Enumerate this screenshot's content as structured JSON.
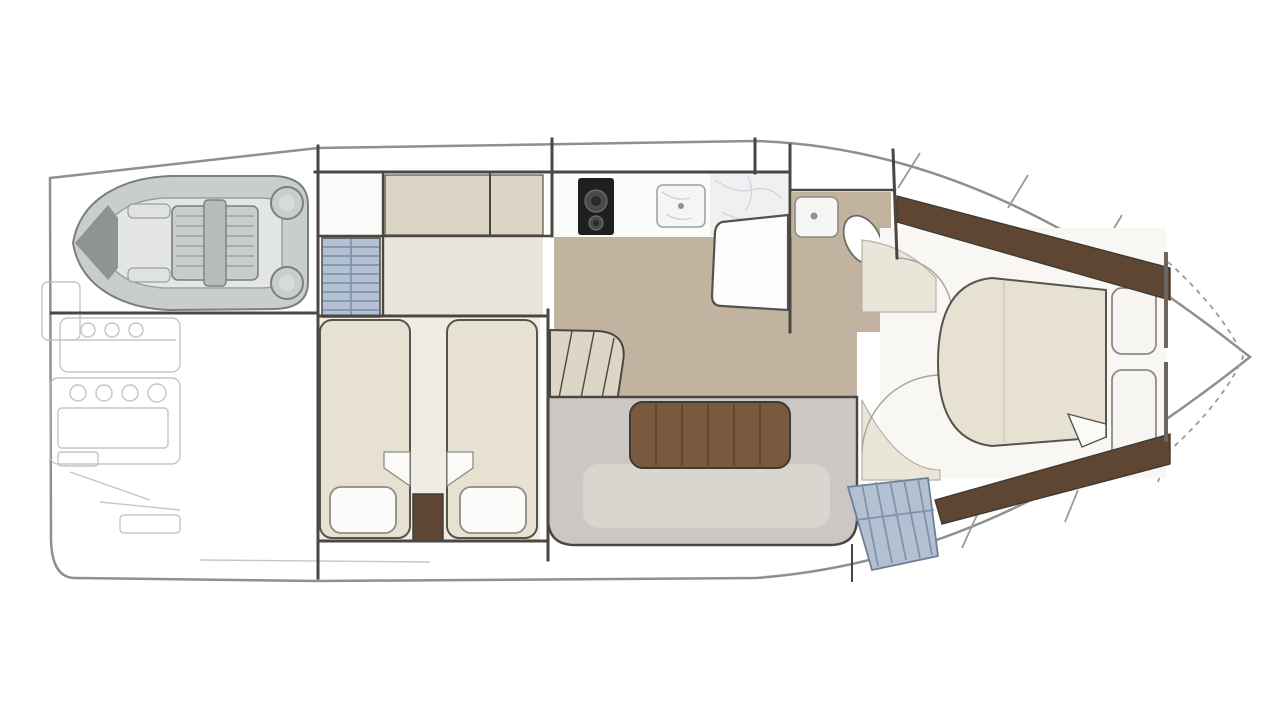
{
  "title": "Yacht lower deck floor plan",
  "rooms": {
    "hull": "Hull outline",
    "garage": "Tender garage",
    "tender": "Inflatable tender dinghy",
    "engine_room": "Engine room machinery",
    "stairs_main": "Companionway stairs",
    "guest_cabin": "Twin guest cabin",
    "bed_left": "Guest berth port",
    "bed_right": "Guest berth starboard",
    "galley": "Galley",
    "stove": "Two-burner stove",
    "sink": "Galley sink",
    "salon": "Dinette salon",
    "table": "Salon wood table",
    "sofa": "U-shaped settee",
    "steps": "Salon entry steps",
    "seat": "Salon side seat",
    "bathroom": "Head / bathroom",
    "toilet": "Toilet",
    "basin": "Wash basin",
    "master_cabin": "Master cabin",
    "master_bed": "Island double bed",
    "wardrobe_top": "Wardrobe port side",
    "wardrobe_bottom": "Wardrobe starboard side",
    "bow_stairs": "Forward stairs",
    "bow": "Bow deck"
  },
  "palette": {
    "wall": "#4a4742",
    "wall_medium": "#6b675f",
    "hull": "#8f8f8b",
    "deck_seam": "#9a9a96",
    "floor_tan": "#c2b3a1",
    "floor_beige": "#efece4",
    "cabinet": "#dcd5c6",
    "counter": "#fbfbfa",
    "marble": "#eef0f2",
    "marble_vein": "#c7ccd2",
    "bed": "#e7e1d2",
    "bed_outline": "#57544e",
    "pillow": "#fbfbf9",
    "wood_dark": "#5f4632",
    "wood_table": "#7a5a3e",
    "wood_plank_line": "#55402c",
    "sofa": "#cbc8c3",
    "sofa_inner": "#d9d6d0",
    "stairs": "#b3c0d2",
    "stairs_line": "#7e92ac",
    "stove": "#1f1f1f",
    "burner": "#4b4b4b",
    "burner_inner": "#2a2a2a",
    "tender_tube": "#c9cdcc",
    "tender_outline": "#7a7f81",
    "tender_floor": "#e3e6e4",
    "tender_detail": "#9aa0a0",
    "tender_dark": "#8e9494",
    "faint": "#bcbcb8",
    "white": "#ffffff",
    "arc": "#a7a49e",
    "accent_beige": "#eae5d9",
    "panel": "#f6f5f1",
    "master_floor": "#f8f7f4",
    "blanket": "#fafaf7",
    "steps_fill": "#ddd6c7"
  }
}
